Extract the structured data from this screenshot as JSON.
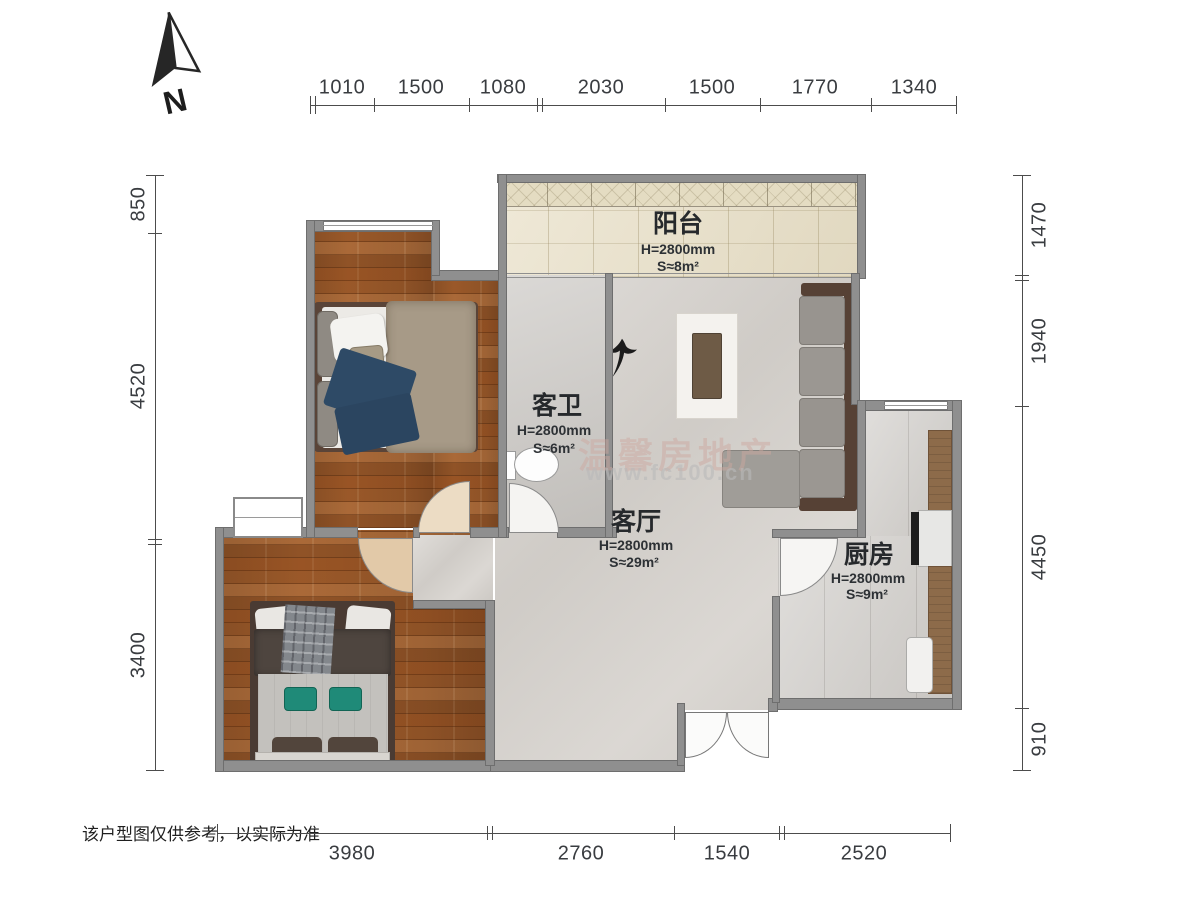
{
  "north": {
    "label": "N"
  },
  "watermark": {
    "line1": "温馨房地产",
    "line2": "www.fc100.cn"
  },
  "disclaimer": "该户型图仅供参考，以实际为准",
  "rooms": {
    "balcony": {
      "name": "阳台",
      "height": "H=2800mm",
      "area": "S≈8m²"
    },
    "bathroom": {
      "name": "客卫",
      "height": "H=2800mm",
      "area": "S≈6m²"
    },
    "living": {
      "name": "客厅",
      "height": "H=2800mm",
      "area": "S≈29m²"
    },
    "kitchen": {
      "name": "厨房",
      "height": "H=2800mm",
      "area": "S≈9m²"
    }
  },
  "dimensions": {
    "top": [
      1010,
      1500,
      1080,
      2030,
      1500,
      1770,
      1340
    ],
    "left": [
      850,
      4520,
      3400
    ],
    "right": [
      1470,
      1940,
      4450,
      910
    ],
    "bottom": [
      3980,
      2760,
      1540,
      2520
    ]
  },
  "colors": {
    "wall": "#8f8f8f",
    "wood": "#a05c2b",
    "tile": "#d6d2cd",
    "balcony": "#e8dfc6",
    "sofa_frame": "#564135",
    "accent_teal": "#1f8a78"
  }
}
